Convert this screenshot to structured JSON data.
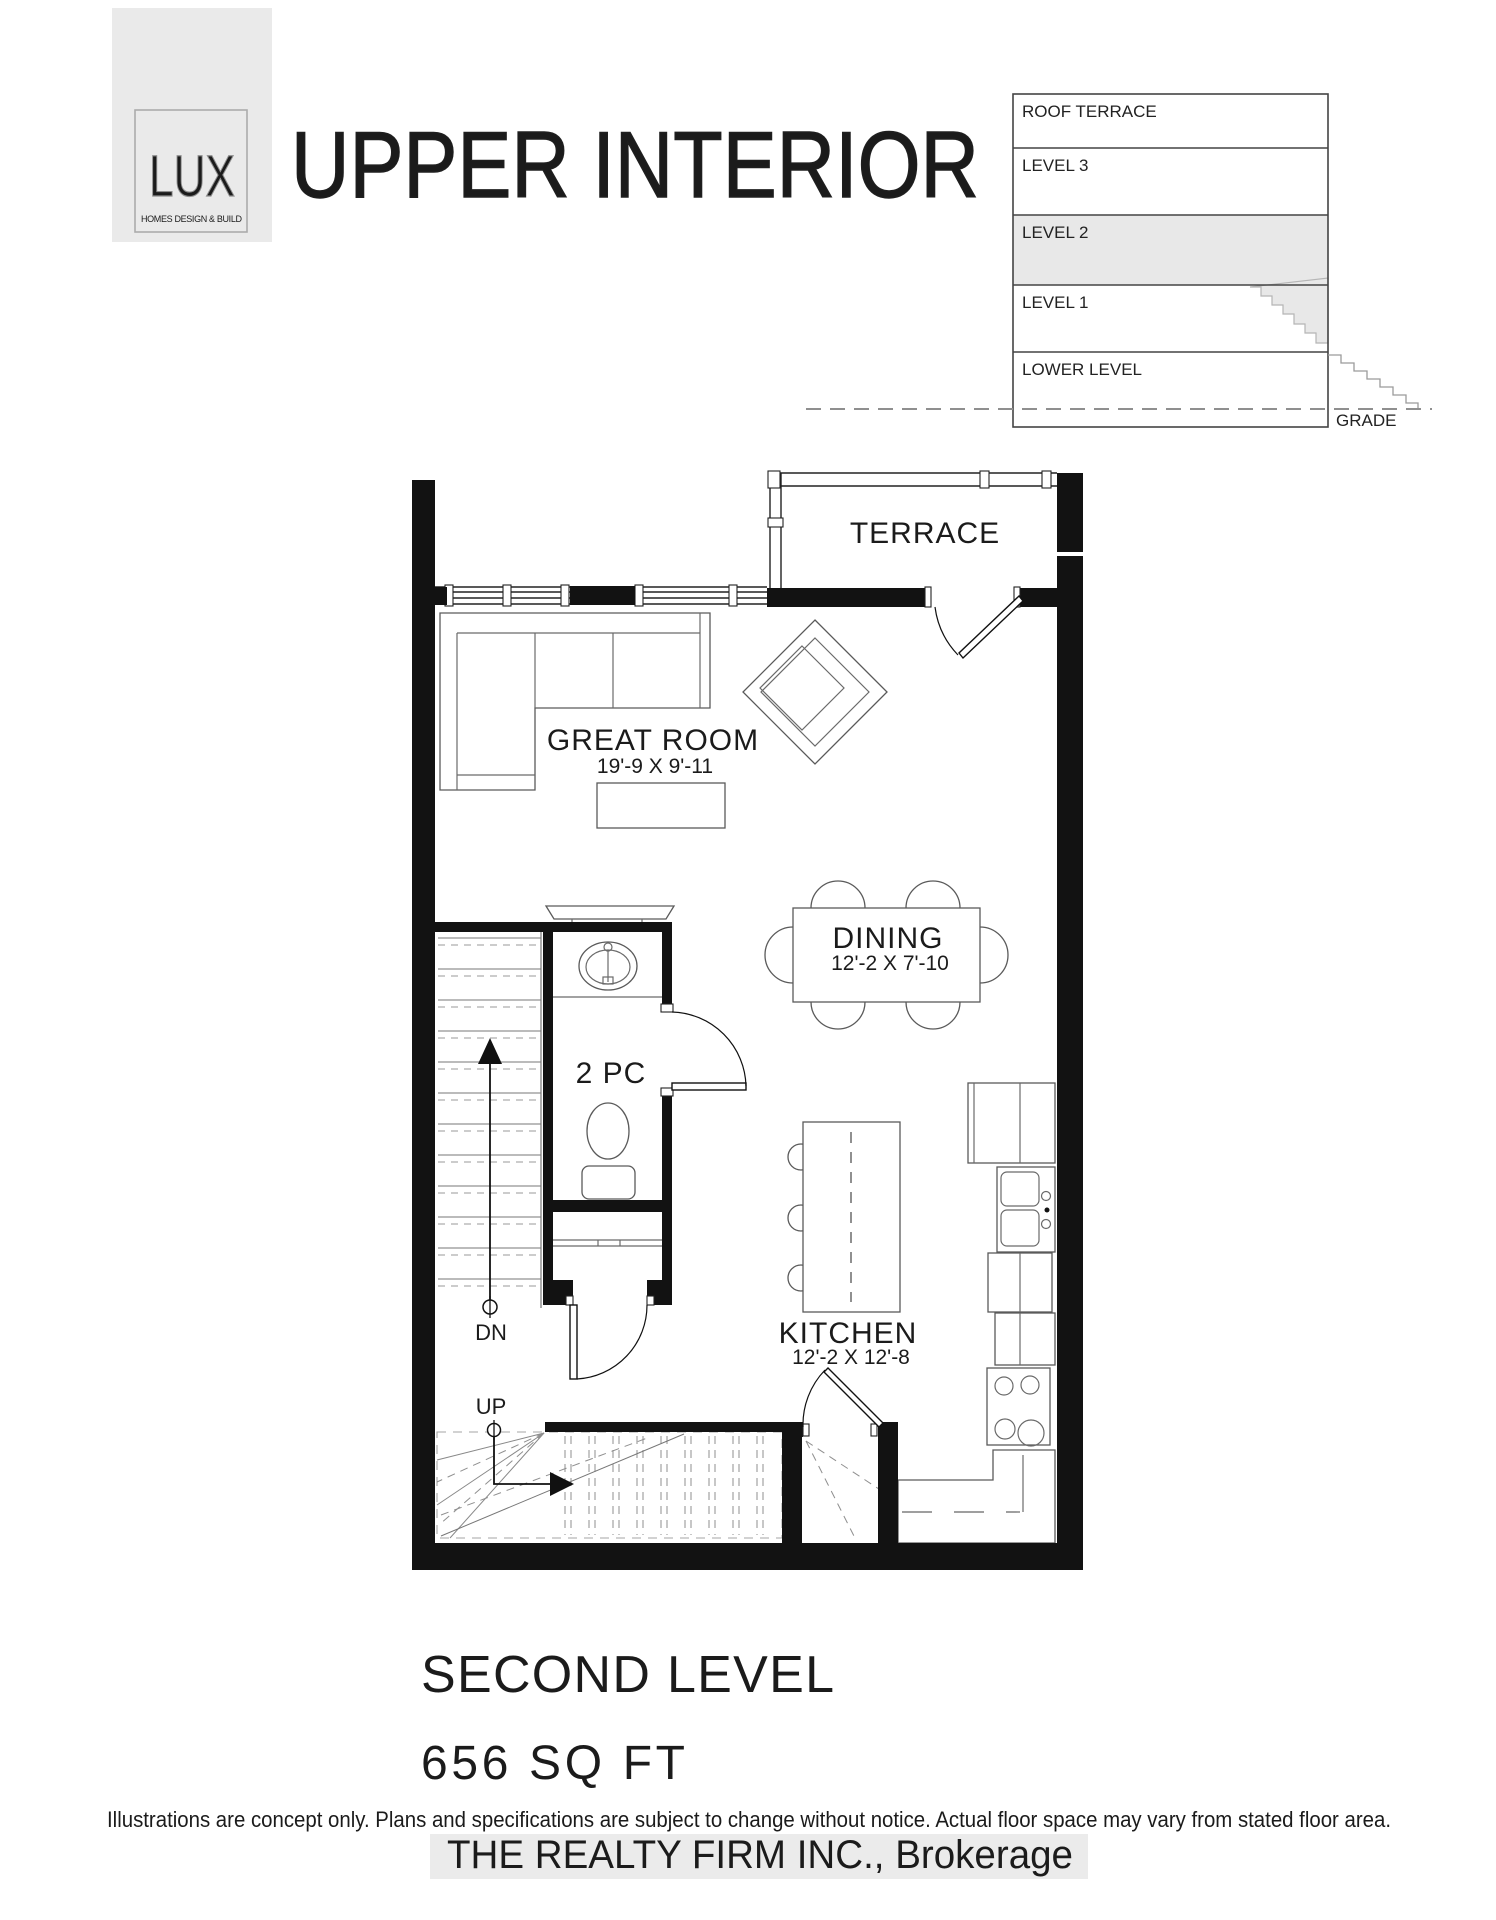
{
  "header": {
    "logo": {
      "name": "LUX",
      "tagline": "HOMES DESIGN & BUILD"
    },
    "title": "UPPER INTERIOR"
  },
  "level_indicator": {
    "levels": [
      "ROOF TERRACE",
      "LEVEL 3",
      "LEVEL 2",
      "LEVEL 1",
      "LOWER LEVEL"
    ],
    "highlighted": "LEVEL 2",
    "highlight_color": "#e8e8e8",
    "grade_label": "GRADE"
  },
  "floor_plan": {
    "wall_color": "#121212",
    "rooms": [
      {
        "name": "TERRACE",
        "dims": ""
      },
      {
        "name": "GREAT ROOM",
        "dims": "19'-9 X 9'-11"
      },
      {
        "name": "DINING",
        "dims": "12'-2 X 7'-10"
      },
      {
        "name": "2 PC",
        "dims": ""
      },
      {
        "name": "KITCHEN",
        "dims": "12'-2 X 12'-8"
      }
    ],
    "stairs": {
      "down_label": "DN",
      "up_label": "UP"
    }
  },
  "footer": {
    "level_title": "SECOND LEVEL",
    "area": "656 SQ FT",
    "disclaimer": "Illustrations are concept only. Plans and specifications are subject to change without notice. Actual floor space may vary from stated floor area.",
    "watermark": "THE REALTY FIRM INC., Brokerage"
  }
}
